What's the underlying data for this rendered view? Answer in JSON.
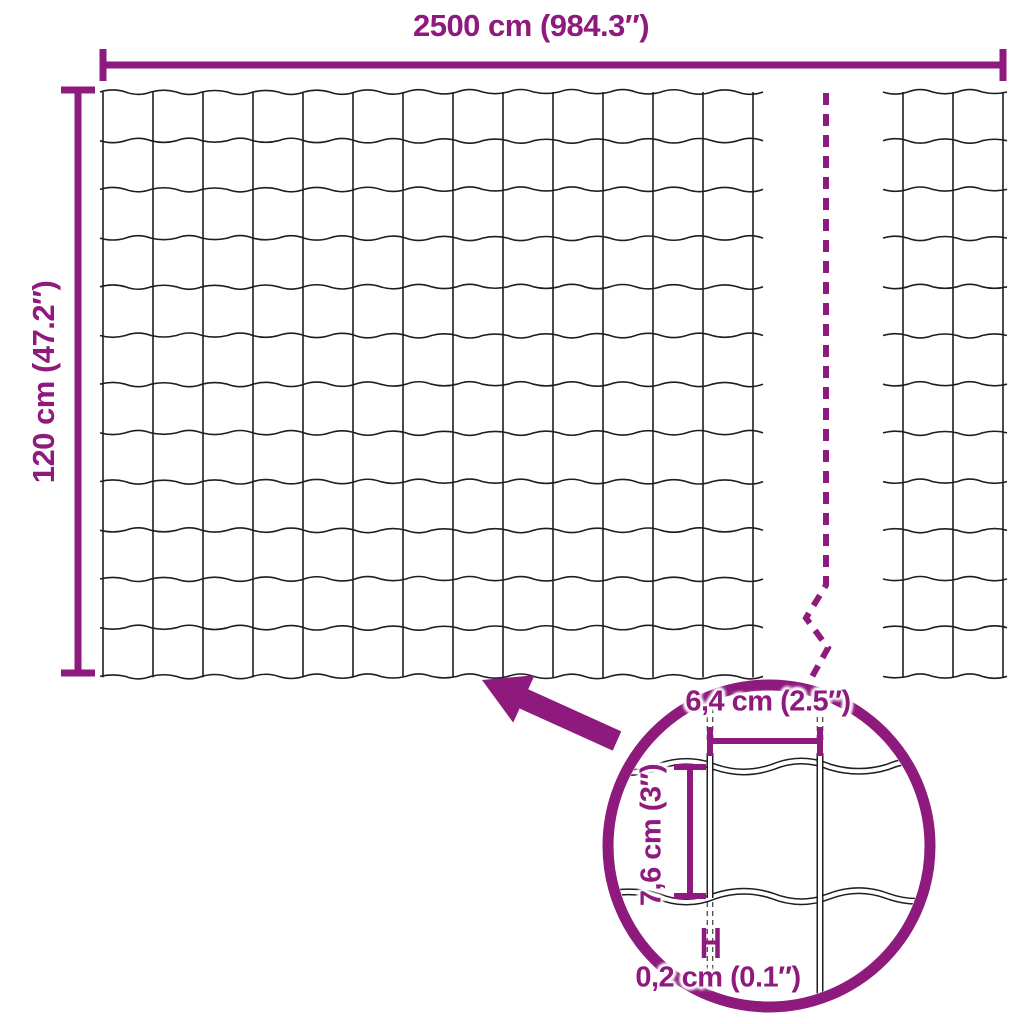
{
  "colors": {
    "accent": "#8E1A7E",
    "wire": "#1E1E1E",
    "background": "#FFFFFF"
  },
  "icons": {
    "zoom_arrow": "arrow-pointing-up-left",
    "detail_magnifier": "magnifier-circle",
    "break_line": "dashed-break-line"
  },
  "labels": {
    "overall_width": "2500 cm (984.3″)",
    "overall_height": "120 cm (47.2″)",
    "mesh_opening_width": "6,4 cm (2.5″)",
    "mesh_opening_height": "7,6 cm (3″)",
    "wire_thickness": "0,2 cm (0.1″)"
  }
}
